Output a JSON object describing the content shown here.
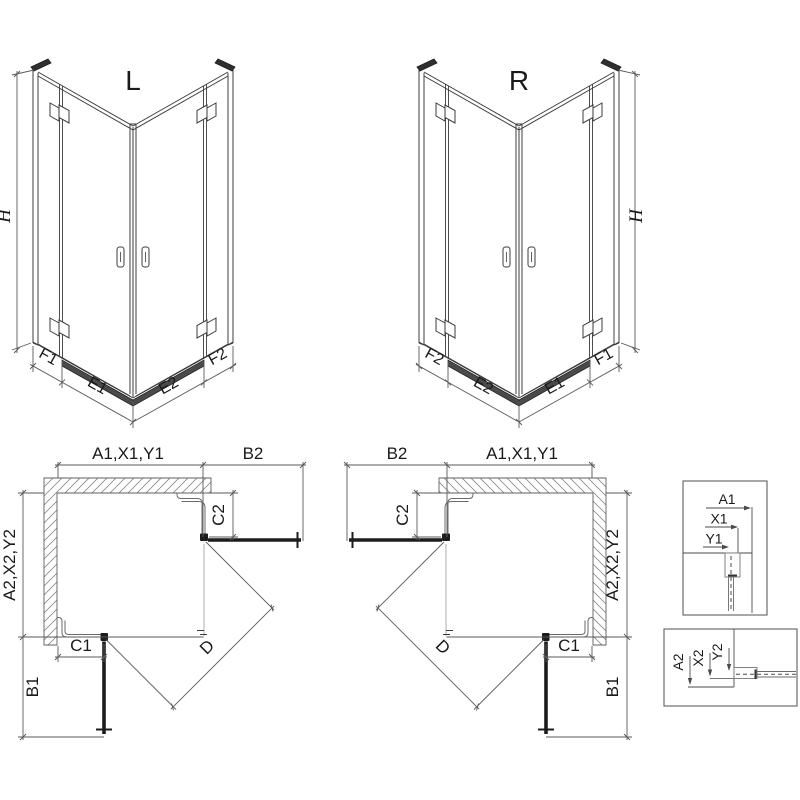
{
  "iso_left": {
    "title": "L",
    "height_label": "H",
    "bottom_segments": [
      "F1",
      "E1",
      "E2",
      "F2"
    ]
  },
  "iso_right": {
    "title": "R",
    "height_label": "H",
    "bottom_segments": [
      "F2",
      "E2",
      "E1",
      "F1"
    ]
  },
  "plan_left": {
    "width_total": "A1,X1,Y1",
    "door_extension_top": "B2",
    "depth_total": "A2,X2,Y2",
    "door_extension_side": "B1",
    "fixed_panel_top": "C2",
    "fixed_panel_bottom": "C1",
    "entry_diagonal": "D"
  },
  "plan_right": {
    "width_total": "A1,X1,Y1",
    "door_extension_top": "B2",
    "depth_total": "A2,X2,Y2",
    "door_extension_side": "B1",
    "fixed_panel_top": "C2",
    "fixed_panel_bottom": "C1",
    "entry_diagonal": "D"
  },
  "detail_top": {
    "labels": [
      "A1",
      "X1",
      "Y1"
    ]
  },
  "detail_bottom": {
    "labels": [
      "A2",
      "X2",
      "Y2"
    ]
  },
  "colors": {
    "line": "#3c3c3c",
    "dimension": "#5a5a5a",
    "dark_profile": "#1c1c1c",
    "threshold": "#4a4a4a",
    "hatch": "#8a8a8a",
    "background": "#ffffff"
  }
}
